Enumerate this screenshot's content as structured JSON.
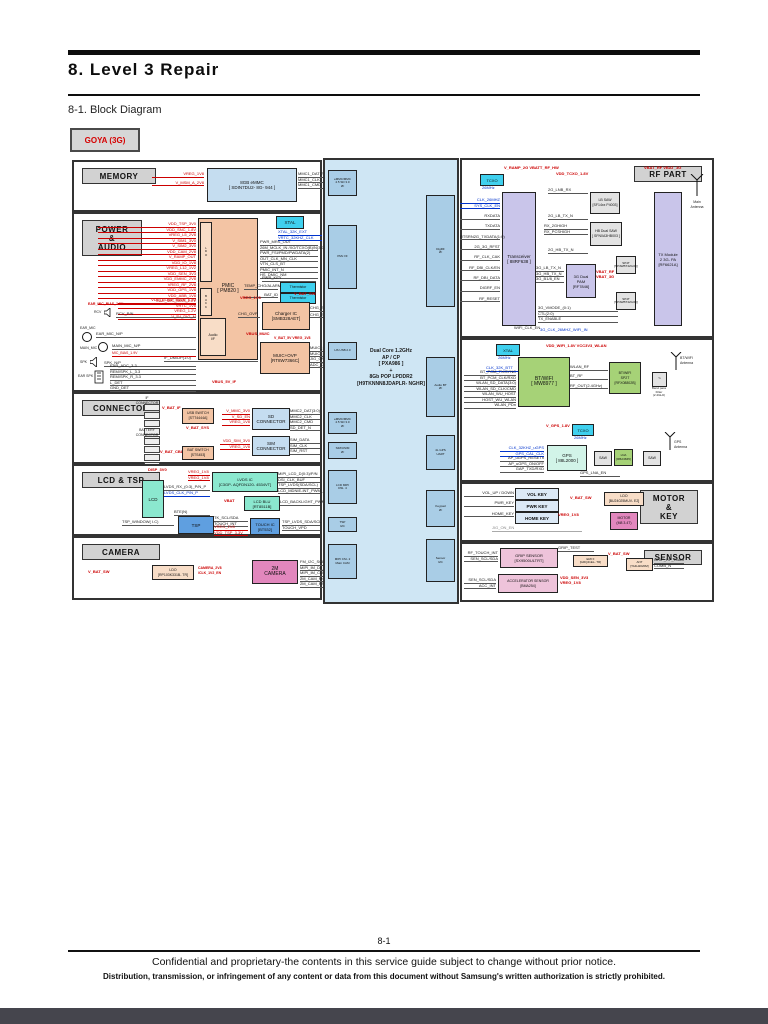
{
  "page": {
    "title": "8.  Level  3  Repair",
    "subtitle": "8-1.  Block  Diagram",
    "model": "GOYA (3G)",
    "page_number": "8-1",
    "footer_line1": "Confidential and proprietary-the contents in this service guide subject to change without prior notice.",
    "footer_line2": "Distribution, transmission, or infringement of any content or data from this document without Samsung's written authorization is strictly prohibited."
  },
  "memory": {
    "label": "MEMORY",
    "emmc": "8GB eMMC\n[ SDIN7DU2- 8G- 944 ]",
    "rails": [
      "VREG_1V8",
      "V_MSM_A_2V8"
    ],
    "bus": [
      "MMC1_DAT(7:0)",
      "MMC1_CLK",
      "MMC1_CMD"
    ]
  },
  "power": {
    "label": "POWER\n&\nAUDIO",
    "pmic": "PMIC\n[ PM820 ]",
    "ldo": "L\nD\nO",
    "buck": "B\nU\nC\nK",
    "audio_if": "Audio\nI/F",
    "xtal": "XTAL",
    "xtal_sigs": [
      "XTAL_32K_EXT",
      "VRTC_32KHZ_CLK"
    ],
    "rails1": [
      "VDD_TSP_3V0",
      "VDD_SNC_1.8V",
      "VREG_L5_2V8",
      "V_SIM1_3V0",
      "V_SIM2_3V0",
      "VDD_CAM_2V8",
      "V_RAMP_OUT",
      "VDD_IO_1V8",
      "VREG_L12_1V2",
      "VDD_SEN_3V3",
      "VDD_EMMC_2V8",
      "VREG_RF_2V8",
      "VDD_GPS_1V8",
      "VDD_ABB_1V8",
      "EAR_MIC_BIAS_2.2V"
    ],
    "rails2": [
      "VDD_CORE_MAIN_1.2V",
      "VRTC_1V8",
      "VREG_1.2V",
      "V_5V_DIG_M"
    ],
    "cpu_sigs": [
      "PWR_MRS_OUT",
      "26M_MCLK_IN /XO/TCXO(B)/N(3:0)",
      "PWR_FSI/PMD/PWDATA(2)",
      "OUT_CLK_MN_CLK",
      "VTN_CLS_BT",
      "PMIC_INT_N",
      "HS_DMIC_NM"
    ],
    "pwr_key": "PWR_KEY",
    "therm": "Thermistor",
    "therm_sigs": [
      "TEMP_CHG/ALARM",
      "BAT_ID"
    ],
    "charger": "Charger IC\n[SMB328AET]",
    "chg_vreg": "VREG_1V8",
    "chg_vbat": "V_BAT_SW",
    "chg_left": "CHG_OVP",
    "chg_sigs": [
      "CHG_SDA/SCL",
      "CHG_STAT"
    ],
    "vbus": "VBUS_MUIC",
    "muic": "MUIC+OVP\n[RT8W7366C]",
    "muic_rails": "V_BAT_5V  VREG_1V8",
    "muic_sigs": [
      "MUIC_SDA/SCL",
      "MUIC_INT_N",
      "JIG_ON",
      "ADC_CHECK"
    ],
    "usb_sig": "IF_DM/DP(1:0)",
    "vbus_if": "VBUS_5V_IF",
    "audio": {
      "rcv": "RCV",
      "rcv_sig": "RCV_P/N",
      "ear_mic": "EAR_MIC",
      "ear_mic_sig": "EAR_MIC_N/P",
      "main_mic": "MAIN_MIC",
      "main_mic_sig": "MAIN_MIC_N/P",
      "mic_bias": "MIC_BIAS_1.9V",
      "spk": "SPK",
      "spk_sig": "SPK_N/P",
      "ear": "EAR SPK",
      "ear_sigs": [
        "EAR_ADC_3.3",
        "REM/SPK_L_3.3",
        "REM/SPK_R_3.3",
        "L_DET",
        "GND_DET"
      ]
    }
  },
  "connector": {
    "label": "CONNECTOR",
    "if_conn": "IF\nCONNECTOR",
    "bat_conn": "BATTERY\nCONNECTOR",
    "usb_switch": "USB SWITCH\n[STT4444A]",
    "bat_switch": "BAT SWITCH\n[STS453]",
    "v_bat_if": "V_BAT_IF",
    "v_bat_sys": "V_BAT_SYS",
    "v_bat_cbl": "V_BAT_CBL",
    "sd": "SD\nCONNECTOR",
    "sd_rails": [
      "V_MMC_3V0",
      "V_SD_EN",
      "VREG_1V8"
    ],
    "sd_sigs": [
      "MMC2_DAT(3:0)",
      "MMC2_CLK",
      "MMC2_CMD",
      "SD_DET_N"
    ],
    "sim": "SIM\nCONNECTOR",
    "sim_rails": [
      "VDD_SIM_3V0",
      "VREG_1V8"
    ],
    "sim_sigs": [
      "SIM_DATA",
      "SIM_CLK",
      "SIM_RST"
    ]
  },
  "lcdtsp": {
    "label": "LCD & TSP",
    "disp": "DISP_3V0",
    "lcd": "LCD",
    "lvds": "LVDS IC\n[C3GP- AQFDN120- 4534VT]",
    "lvds_rails": [
      "VREG_1V8",
      "VREG_1V8"
    ],
    "lcd_sig1": "LVDS_RX_(0:3)_P/N_P",
    "lcd_sig2": "LVDS_CLK_P/N_P",
    "mipi_sigs": [
      "MIPI_LCD_D(0:3)/P/N",
      "DSI_CLK_BUF",
      "TSP_LVDS(SDA/SCL)",
      "LCD_MDNIE-INT_PWM_W"
    ],
    "blu": "LCD BLU\n[RT8511B]",
    "vbat": "VBAT",
    "blu_sig": "LCD_BACKLIGHT_PWM",
    "bte": "BTE(N)",
    "tsp": "TSP",
    "touch": "TOUCH IC\n[BT532]",
    "tsp_sigs_k": [
      "TK_SCL/SDA",
      "TOUCH_INT"
    ],
    "tsp_sigs_r": [
      "VREG_1V8",
      "VDD_TSP_3.3V"
    ],
    "touch_sigs": [
      "TSP_LVDS_SDA/SCL",
      "TOUCH_VPD"
    ],
    "tsp_left": "TSP_WINDOW( I.C)"
  },
  "camera": {
    "label": "CAMERA",
    "v_bat_sw": "V_BAT_SW",
    "ldo": "LDO\n[RP103K331B- TR]",
    "en": "CAMERA_2V8\n/CLK_1V2_EN",
    "cam": "2M\nCAMERA",
    "sigs": [
      "FM_I2C_SCL/SDA",
      "MIPI_IM_D0_P/N",
      "MIPI_IM_CLK_P/N",
      "2M_CAM_MCLK",
      "2M_CAM_RST/N_STBY"
    ]
  },
  "cpu": {
    "title": "Dual Core 1.2GHz\nAP / CP\n[ PXA986 ]\n+\n8Gb POP LPDDR2\n[H9TKNNN8JDAPLR- NGHR]",
    "if_emmc1": "eMMC/MMC\n4.5 SD 3.0\nI/F",
    "if_pmx": "PMx I/F",
    "if_usb": "HS USB 2.0",
    "if_emmc2": "eMMC/MMC\n4.5 SD 3.0\nI/F",
    "if_sim": "SIM/USIM\nI/F",
    "if_lcd": "LCD MIPI\nDSI- 4",
    "if_tsp": "TSP\nI2C",
    "if_cam": "MIPI CSI- 2\nMain CAM",
    "if_digrf": "DigRF\nI/F",
    "if_bt": "Audio BT\nI/F",
    "if_gps": "4L GPS\nUART",
    "if_key": "Keypad\nI/F",
    "if_sensor": "Sensor\nI2C"
  },
  "rf": {
    "label": "RF PART",
    "tcxo": "TCXO",
    "tcxo_freq": "26MHz",
    "vramp": "V_RAMP_2G  VBATT_RF_HW",
    "vtcxo": "VDD_TCXO_1.8V",
    "vbat": "VBAT_RF   VBAT_3G",
    "transceiver": "Transceiver\n[ 88RF638 ]",
    "left_blue": [
      "CLK_26MHZ",
      "SYS_CLK_EN"
    ],
    "left_sigs": [
      "RXDATA",
      "TXDATA",
      "RTSRN2G_TXDATA(1:0)",
      "2G_3G_RFST",
      "RF_CLK_CAK",
      "RF_DBI_CLK/EN",
      "RF_DBI_DATA",
      "DIGRF_EN",
      "RF_RESET"
    ],
    "lb_saw": "LB SAW\n[SF14xx P4003]",
    "rx_top": "2G_LNB_RX",
    "lb_tx": "2G_LB_TX_N",
    "hb_saw": "HB Dual SAW\n[ SFN0A3HB003 ]",
    "hb_sigs": [
      "RX_2GHIGH",
      "RX_PCSHIGH"
    ],
    "hb_tx": "2G_HB_TX_N",
    "pam": "3G Dual\nPAM\n[RF7846]",
    "pam_rails": "VBAT_RF\nVBAT_3G",
    "pam_sigs": [
      "3G_LB_TX_N",
      "3G_HB_TX_N",
      "3G_B1/8_EN"
    ],
    "sw1": "SP4T\n[SP4WBT42G3Q]",
    "sw2": "SP4T\n[SP4WBT42G3Q]",
    "tx": "TX Module\n2 3G- PA\n[RF6621A]",
    "ant": "Main\nAntenna",
    "bottom_sigs": [
      "3G_VMODE_(0:1)",
      "CTL(2:0)",
      "TX_ENABLE"
    ],
    "wifi_clk": "WIFI_CLK_EN",
    "wifi_clk_blue": "3G_CLK_26MHZ_WIFI_IN"
  },
  "btgps": {
    "xtal": "XTAL",
    "xtal_freq": "26MHz",
    "clk_blue": "CLK_32K_BTT",
    "rails": "VDD_WIFI_1.8V  VCC3V3_WLAN",
    "btwifi": "BT/WIFI\n[ MW8977 ]",
    "left_sigs": [
      "BT_PCM_TX/SYNC",
      "BT_PCM_CLK/RXD",
      "WLAN_SD_DATA(3:0)",
      "WLAN_SD_CLK/CMD",
      "WLAN_WU_HOST",
      "HOST_WU_WLAN",
      "WLAN_PDn"
    ],
    "sp2t": "BT/WIFI\nSP2T\n[RFX08802B]",
    "mid_sigs": [
      "WLAN_RF",
      "BT_RF",
      "RF_OUT(2.4GHz)"
    ],
    "bpf": "Band pass\nFilter\n(2.4GHz)",
    "bt_ant": "BT/WIFI\nAntenna",
    "v_gps": "V_GPS_1.8V",
    "tcxo": "TCXO",
    "tcxo_freq": "26MHz",
    "gps": "GPS\n[ 88L2000 ]",
    "gps_blue": [
      "CLK_32KHZ_uGPS",
      "GPS_CAL_CLK"
    ],
    "gps_sigs": [
      "AP_uGPS_RESETn",
      "AP_uGPS_ON/OFF",
      "GAP_TXD/RXD"
    ],
    "saw1": "SAW",
    "lna": "LNA\n[RBA3845]",
    "saw2": "SAW",
    "gps_ant": "GPS\nAntenna",
    "lna_en": "GPS_LNA_EN"
  },
  "motorkey": {
    "label": "MOTOR\n&\nKEY",
    "vol_key": "VOL KEY",
    "pwr_key": "PWR KEY",
    "home_key": "HOME KEY",
    "key_sigs": [
      "VOL_UP / DOWN",
      "PWR_KEY",
      "HOME_KEY"
    ],
    "jig": "JIG_ON_EN",
    "v_bat_sw": "V_BAT_SW",
    "driver": "LDO\n[BU24025MUV- E2]",
    "vreg": "VREG_1V8",
    "motor": "MOTOR\n(M8 3.4T)"
  },
  "sensor": {
    "label": "SENSOR",
    "grip": "GRIP SENSOR\n[SX9500ULTRT]",
    "grip_left": [
      "RF_TOUCH_INT",
      "SEN_SCL/SDA"
    ],
    "grip_test": "GRIP_TEST",
    "v_bat_sw": "V_BAT_SW",
    "emi": "EMI F\n[GRQ41EL- TR]",
    "ant_box": "ANT\n[TA4H2020M]",
    "ant_sigs": [
      "GRIP_RF_Touch",
      "COMB_N"
    ],
    "accel": "ACCELERATOR SENSOR\n[BMA254]",
    "accel_left": [
      "SEN_SCL/SDA",
      "ACC_INT"
    ],
    "accel_rails": "VDD_SEN_3V3\nVREG_1V8"
  }
}
